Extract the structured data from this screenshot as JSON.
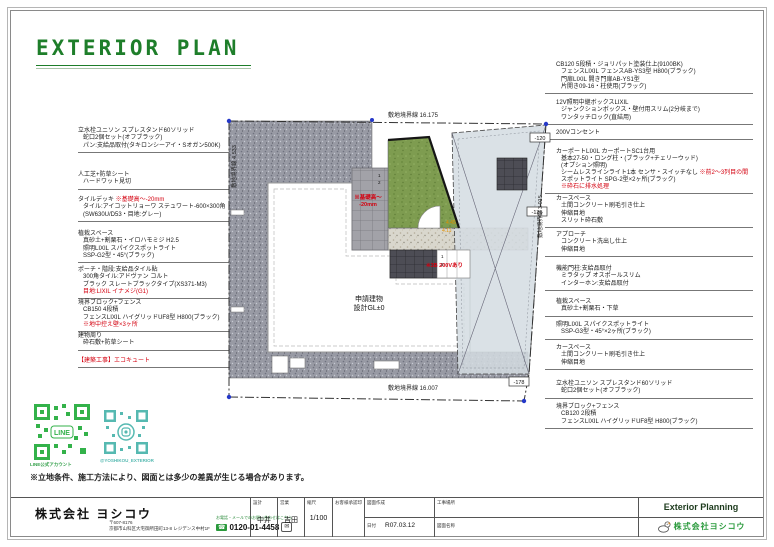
{
  "title": {
    "text": "EXTERIOR PLAN"
  },
  "disclaimer": "※立地条件、施工方法により、図面とは多少の差異が生じる場合があります。",
  "qr": {
    "line_caption": "LINE公式アカウント",
    "line_label": "LINE",
    "insta_caption": "@YOSHIKOU_EXTERIOR"
  },
  "left_annotations": [
    {
      "lines": [
        "立水栓ユニソン スプレスタンド60ソリッド",
        "蛇口2個セット(オフブラック)",
        "パン:支給品取付(タキロンシーアイ・Sオガン500K)"
      ]
    },
    {
      "lines": [
        "人工芝+防草シート",
        "ハードワット見切"
      ]
    },
    {
      "head": "タイルデッキ ",
      "note": "※基礎高～-20mm",
      "lines": [
        "タイル:アイコットリョーワ ステュワート-600×300角",
        "(SW630U/D53・目地:グレー)"
      ]
    },
    {
      "lines": [
        "植栽スペース",
        "真砂土+割栗石・イロハモミジ H2.5",
        "照明LIXIL スパイクスポットライト",
        "SSP-G2型・45°(ブラック)"
      ]
    },
    {
      "lines": [
        "ポーチ・階段:支給品タイル貼",
        "300角タイル:アドヴァン コルト",
        "ブラック スレートブラックタイプ(XS371-M3)"
      ],
      "note": "目地:LIXIL イナメジ(G1)"
    },
    {
      "lines": [
        "境界ブロック+フェンス",
        "CB150 4段積",
        "フェンスLIXIL ハイグリッドUF8型 H800(ブラック)"
      ],
      "note": "※地中控え壁×3ヶ所"
    },
    {
      "lines": [
        "建物周り",
        "砕石敷+防草シート"
      ]
    },
    {
      "note": "【建築工事】エコキュート"
    }
  ],
  "right_annotations": [
    {
      "lines": [
        "CB120 5段積・ジョリパット塗装仕上(9100BK)",
        "フェンスLIXIL フェンスAB-YS3型 H800(ブラック)",
        "門扉LIXIL 開き門扉AB-YS1型",
        "片開き09-16・柱使用(ブラック)"
      ]
    },
    {
      "lines": [
        "12V照明中継ボックスLIXIL",
        "ジャンクションボックス・壁付用スリム(2分岐まで)",
        "ワンタッチロック(直結用)"
      ]
    },
    {
      "lines": [
        "200Vコンセント"
      ]
    },
    {
      "lines": [
        "カーポートLIXIL カーポートSC1台用",
        "基本27-50・ロング柱・(ブラック+チェリーウッド)",
        "(オプション照明)"
      ],
      "mixed_head": "シームレスラインライト1本 センサ・スイッチなし ",
      "mixed_note": "※前2～3列目の間",
      "line_after": "スポットライト SPG-2型×2ヶ所(ブラック)",
      "note": "※砕石に排水処理"
    },
    {
      "lines": [
        "カースペース",
        "土間コンクリート刷毛引き仕上",
        "伸縮目地",
        "スリット砕石敷"
      ]
    },
    {
      "lines": [
        "アプローチ",
        "コンクリート洗出し仕上",
        "伸縮目地"
      ]
    },
    {
      "lines": [
        "機能門柱:支給品取付",
        "ミラタップ オスポールスリム",
        "インターホン:支給品取付"
      ]
    },
    {
      "lines": [
        "植栽スペース",
        "真砂土+割栗石・下草"
      ]
    },
    {
      "lines": [
        "照明LIXIL スパイクスポットライト",
        "SSP-G3型・45°×2ヶ所(ブラック)"
      ]
    },
    {
      "lines": [
        "カースペース",
        "土間コンクリート刷毛引き仕上",
        "伸縮目地"
      ]
    },
    {
      "lines": [
        "立水栓ユニソン スプレスタンド60ソリッド",
        "蛇口2個セット(オフブラック)"
      ]
    },
    {
      "lines": [
        "境界ブロック+フェンス",
        "CB120 2段積",
        "フェンスLIXIL ハイグリッドUF8型 H800(ブラック)"
      ]
    }
  ],
  "plan": {
    "building_name": "申請建物",
    "building_gl": "設計GL±0",
    "boundary_top": "敷地境界線 16.175",
    "boundary_bottom": "敷地境界線 16.007",
    "boundary_left": "敷地境界線 4.533",
    "boundary_right": "敷地境界線 3.015",
    "level_1": "-120",
    "level_2": "-135",
    "level_3": "-178",
    "note_base_1": "※基礎高～",
    "note_base_2": "-20mm",
    "note_200v": "※3B 200Vあり",
    "dim_1": "4.45",
    "dim_2": "4.11",
    "step_1": "1",
    "step_2": "2"
  },
  "footer": {
    "company": "株式会社 ヨシコウ",
    "postal": "〒607-8176",
    "address": "京都市山科区大宅御所田町13-8 レジデンス中村1F",
    "contact_note": "お電話・メールでのお問い合わせはこちら",
    "phone": "0120-01-4458",
    "design_label": "設計",
    "design_value": "中井",
    "sales_label": "営業",
    "sales_value": "吉田",
    "scale_label": "縮尺",
    "scale_value": "1/100",
    "approval_label": "お客様承認印",
    "drawing_label": "図面作成",
    "date_label": "日付",
    "date_value": "R07.03.12",
    "site_label": "工事場所",
    "name_label": "図面名称",
    "brand": "Exterior Planning",
    "brand_company": "株式会社ヨシコウ"
  },
  "colors": {
    "accent_green": "#1e7e2a",
    "warn_red": "#d4000f",
    "turf": "#7e9c50",
    "gravel": "#989aa4",
    "carport": "#d4dce2",
    "line_green": "#33b24a",
    "insta_teal": "#56b9b1"
  }
}
